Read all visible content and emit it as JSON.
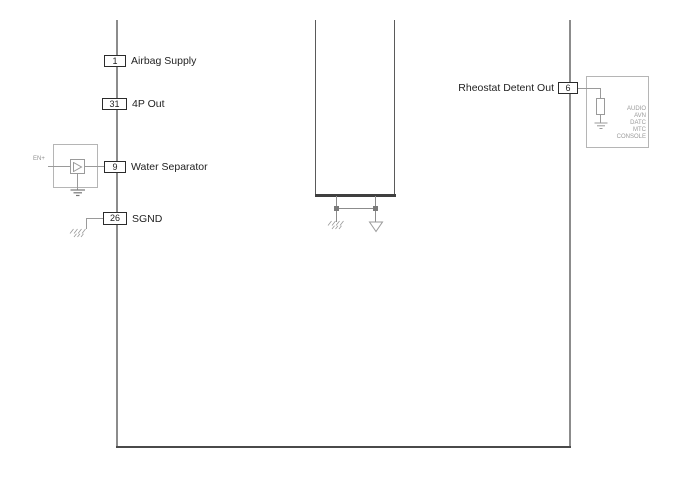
{
  "diagram": {
    "type": "wiring-schematic",
    "left_pins": [
      {
        "number": "1",
        "label": "Airbag Supply"
      },
      {
        "number": "31",
        "label": "4P Out"
      },
      {
        "number": "9",
        "label": "Water Separator"
      },
      {
        "number": "26",
        "label": "SGND"
      }
    ],
    "right_pin": {
      "number": "6",
      "label": "Rheostat Detent Out"
    },
    "amplifier": {
      "input_label": "EN+"
    },
    "right_module_lines": [
      "AUDIO",
      "AVN",
      "DATC",
      "MTC",
      "CONSOLE"
    ],
    "symbols": [
      "earth-ground-icon",
      "signal-ground-icon",
      "chassis-ground-icon",
      "amplifier-triangle-icon",
      "resistor-icon"
    ],
    "colors": {
      "background": "#ffffff",
      "wire": "#8c8c8c",
      "dark_wire": "#4a4a4a",
      "component_outline": "#b5b5b5",
      "pin_border": "#2b2b2b",
      "text": "#1f1f1f",
      "faint_text": "#9a9a9a"
    }
  }
}
